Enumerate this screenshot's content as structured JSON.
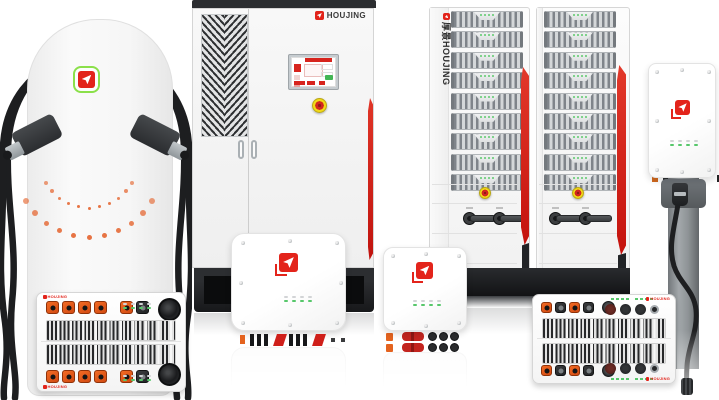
{
  "scene": {
    "background": "#ffffff"
  },
  "brand": {
    "wordmark": "HOUJING",
    "accent_red": "#e2231a",
    "logo_ring_green": "#8be04a",
    "wordmark_color": "#3a3a3a"
  },
  "palette": {
    "stripe_red": "#d71a18",
    "connector_orange": "#e4571c",
    "led_green": "#57c76b",
    "led_dim_gray": "#d2d4d6",
    "estop_yellow": "#f2d818",
    "estop_red": "#d2261f",
    "cabinet_dark": "#17181a",
    "metal_gray": "#8e9396",
    "indicator_dot_orange": "#e4632d"
  },
  "floor_charger": {
    "indicator_arcs": 2,
    "dots_per_arc": 11,
    "cables": 2,
    "holsters": 2
  },
  "power_cabinet": {
    "brand_label": "HOUJING",
    "doors": 2,
    "emergency_stop": 1
  },
  "module_racks": {
    "racks": 2,
    "modules_per_rack": 9,
    "leds_per_module": 4,
    "switches_per_rack": 2,
    "side_label": "厚景HOUJING"
  },
  "wallboxes": {
    "led_columns": 4,
    "led_rows": 2,
    "count": 3
  },
  "psu_left": {
    "brand_label": "HOUJING",
    "orange_connectors": 5,
    "black_connectors": 1,
    "modules": 2
  },
  "psu_right": {
    "brand_label": "HOUJING",
    "square_connectors": 4,
    "round_connectors": 4,
    "modules": 2
  }
}
